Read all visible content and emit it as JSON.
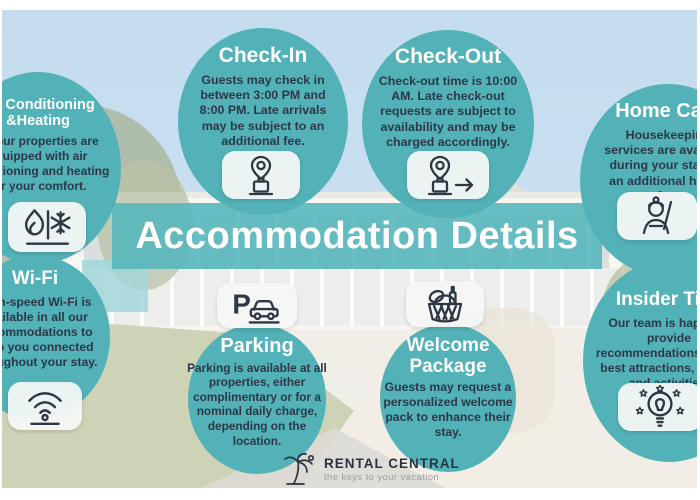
{
  "banner": {
    "title": "Accommodation Details"
  },
  "logo": {
    "name": "RENTAL CENTRAL",
    "tagline": "the keys to your vacation"
  },
  "colors": {
    "bubble_teal": "#52b2b7",
    "banner_teal": "#58b7bd",
    "text_dark": "#2d3748",
    "icon_box_bg": "#f4f7f5",
    "sky": "#a6cae6"
  },
  "bubbles": [
    {
      "id": "check-in",
      "title": "Check-In",
      "icon": "luggage-pin-icon",
      "text": "Guests may check in between 3:00 PM and 8:00 PM. Late arrivals may be subject to an additional fee."
    },
    {
      "id": "check-out",
      "title": "Check-Out",
      "icon": "luggage-depart-icon",
      "text": "Check-out time is 10:00 AM. Late check-out requests are subject to availability and may be charged accordingly."
    },
    {
      "id": "home-care",
      "title": "Home Care",
      "icon": "housekeeper-icon",
      "text": "Housekeeping services are available during your stay for an additional hourly fee."
    },
    {
      "id": "ac-heating",
      "title": "Air Conditioning &Heating",
      "icon": "flame-snowflake-icon",
      "text": "All our properties are equipped with air conditioning and heating for your comfort."
    },
    {
      "id": "wifi",
      "title": "Wi-Fi",
      "icon": "wifi-icon",
      "text": "High-speed Wi-Fi is available in all our accommodations to keep you connected throughout your stay."
    },
    {
      "id": "parking",
      "title": "Parking",
      "icon": "parking-car-icon",
      "text": "Parking is available at all properties, either complimentary or for a nominal daily charge, depending on the location."
    },
    {
      "id": "welcome-package",
      "title": "Welcome Package",
      "icon": "gift-basket-icon",
      "text": "Guests may request a personalized welcome pack to enhance their stay."
    },
    {
      "id": "insider-tips",
      "title": "Insider Tips",
      "icon": "lightbulb-stars-icon",
      "text": "Our team is happy to provide recommendations for the best attractions, dining, and activities."
    }
  ]
}
